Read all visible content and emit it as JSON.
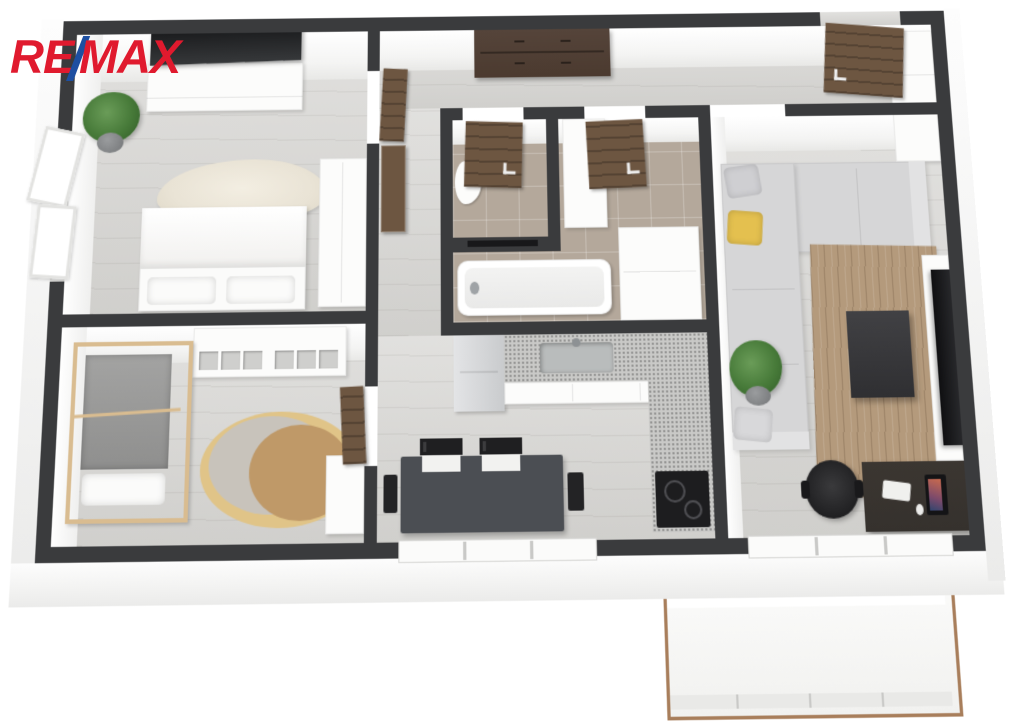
{
  "brand": {
    "logo_re": "RE",
    "logo_slash": "/",
    "logo_max": "MAX"
  },
  "colors": {
    "logo_red": "#e01a2e",
    "logo_blue": "#1d4fa1",
    "wall": "#3a3b3d",
    "floor_wood": "#d7d6d3",
    "floor_tile": "#b4a89b",
    "door_wood": "#6d5641",
    "dresser_wood": "#4b3a2f",
    "dark_furniture": "#35312d",
    "table_gray": "#4b4e53",
    "sofa": "#d6d6d7",
    "rug_living": "#b49a7c",
    "rug_sheepskin": "#e9e3d5",
    "kids_rug_yellow": "#e0c488",
    "kids_rug_gray": "#c8c3bb",
    "kids_rug_tan": "#bf9968",
    "bed_frame_wood": "#d9bc90",
    "accent_pillow": "#e4c04f",
    "counter_speckle": "#c9c9c7",
    "balcony_rail": "#a87e5b"
  },
  "floorplan": {
    "view": "3d-top-down-render",
    "rooms": [
      {
        "name": "bedroom",
        "floor": "light wood",
        "furniture": [
          "wall tv",
          "white sideboard",
          "potted plant",
          "open window",
          "sheepskin rug",
          "double bed with two pillows",
          "white wardrobe"
        ]
      },
      {
        "name": "kids-room",
        "floor": "light wood",
        "furniture": [
          "house-frame bed",
          "cube shelving unit",
          "round layered rug",
          "white desk",
          "door"
        ]
      },
      {
        "name": "hallway",
        "floor": "light wood",
        "furniture": [
          "dark brown dresser",
          "entrance door",
          "white corner wardrobe",
          "brown cabinet"
        ]
      },
      {
        "name": "wc",
        "floor": "beige tile",
        "furniture": [
          "toilet",
          "towel bar",
          "door"
        ]
      },
      {
        "name": "bathroom",
        "floor": "beige tile",
        "furniture": [
          "bathtub",
          "tall white cabinet",
          "washer counter",
          "door"
        ]
      },
      {
        "name": "kitchen",
        "floor": "light wood",
        "furniture": [
          "fridge",
          "l-shaped counter with speckled top",
          "sink",
          "induction cooktop",
          "dark dining table",
          "four black chairs",
          "window"
        ]
      },
      {
        "name": "living-room",
        "floor": "light wood",
        "furniture": [
          "l-shaped gray sofa",
          "yellow pillow",
          "wood-tone rug",
          "dark coffee table",
          "tv lowboard with tv",
          "potted plant",
          "dark desk with monitor keyboard mouse",
          "black office chair",
          "balcony door"
        ]
      },
      {
        "name": "balcony",
        "floor": "white deck",
        "furniture": [
          "thin brown railing"
        ]
      }
    ]
  }
}
